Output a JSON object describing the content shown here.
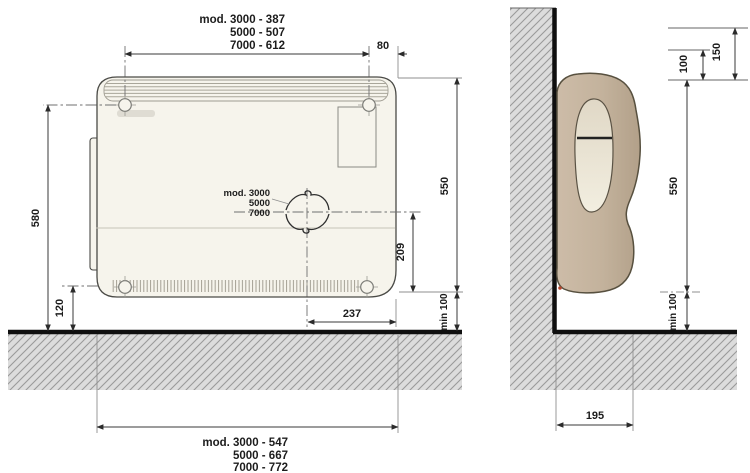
{
  "front_view": {
    "hole_spacing_label": [
      "mod. 3000 - 387",
      "5000 - 507",
      "7000 - 612"
    ],
    "knockout_label": [
      "mod. 3000",
      "5000",
      "7000"
    ],
    "overall_width_label": [
      "mod. 3000 - 547",
      "5000 - 667",
      "7000 - 772"
    ],
    "dims": {
      "hole_offset_right": "80",
      "mount_height": "580",
      "bottom_gap": "120",
      "height": "550",
      "knockout_height": "209",
      "floor_clearance": "min 100",
      "knockout_offset": "237"
    }
  },
  "side_view": {
    "dims": {
      "top_clearance_inner": "100",
      "top_clearance_outer": "150",
      "height": "550",
      "floor_clearance": "min 100",
      "depth": "195"
    }
  },
  "colors": {
    "heater_front_body": "#f6f4ec",
    "heater_side_shell": "#c3b29c",
    "heater_side_panel": "#ece6d7",
    "hatch_fill": "#dcdcdc",
    "hatch_line": "#9a9a9a",
    "dimension_line": "#3a3a3a",
    "floor_wall_line": "#0f0f0f",
    "vent_slot": "#222222",
    "indicator_dot": "#b5442c"
  }
}
